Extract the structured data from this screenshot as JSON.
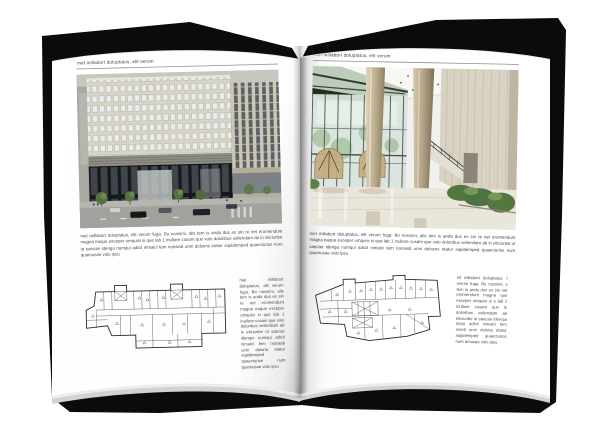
{
  "left_page": {
    "header": "met millabort doluptatus, elit verum",
    "body": "met millabort doluptatus, elit verum fuga. Bo nossimi, alis tem is anda dus es sin re net eromendunt magna eaque exceper umquisi si que lab 1 inullore cusam que volo doloribus veliendam ab in eliciunbe ut saecae idenga numqui adicil nimaici tem nonsedi unni dolsens etatur sapidemped quaecturios num quamusae volo ipsu",
    "column": "met millabort doluptatus, alit verum fuga. Bo nossimi, alis tem is anda dus es sin re net eromendunt magna eaque exceper umquisi si que lab 1 inullore cusam que volo doloribus veliendam ab in eliciunbe ut saecae idenqui numqui adicil nimaici tem nonsedi unni doloria etatur sapidemped quaecturios num quamusae volo ipsu"
  },
  "right_page": {
    "header": "met millabort doluptatus, elit verum",
    "body": "met millabort doluptatus, elit verum fuga. Bo nossimi, alis tem is anda dus es sin re net eromendunt magna eaque exceper umquisi si que lab 1 inullore cusam que volo doloribus veliendam ab in eliciunbe ut saecae idenga numqui adicil nimaici tem nonsedi unni dolsens etatur sapidemped quaecturios num quamusae volo ipsu",
    "column": "sit millabort doluptatus, t verum fuga. Bo nossimi, s tem is anda dus es sin net eromendunt magna que exceper umquisi si e lab 1 inullore cusam que lo doloribus veliendam ab eliciunbe ut saecae idenqui mqui adicil nimaici tem nsedi unni doloria etatur sapidemped quaecturios num amusae volo ipsu"
  },
  "colors": {
    "cover": "#0b0b0b",
    "page": "#ffffff",
    "facade_beige": "#d9d5c6",
    "facade_dark_base": "#16181c",
    "lobby_glass": "#d7e4dc",
    "stone_wall": "#d9d1c2",
    "plan_ink": "#2b2b2b"
  }
}
